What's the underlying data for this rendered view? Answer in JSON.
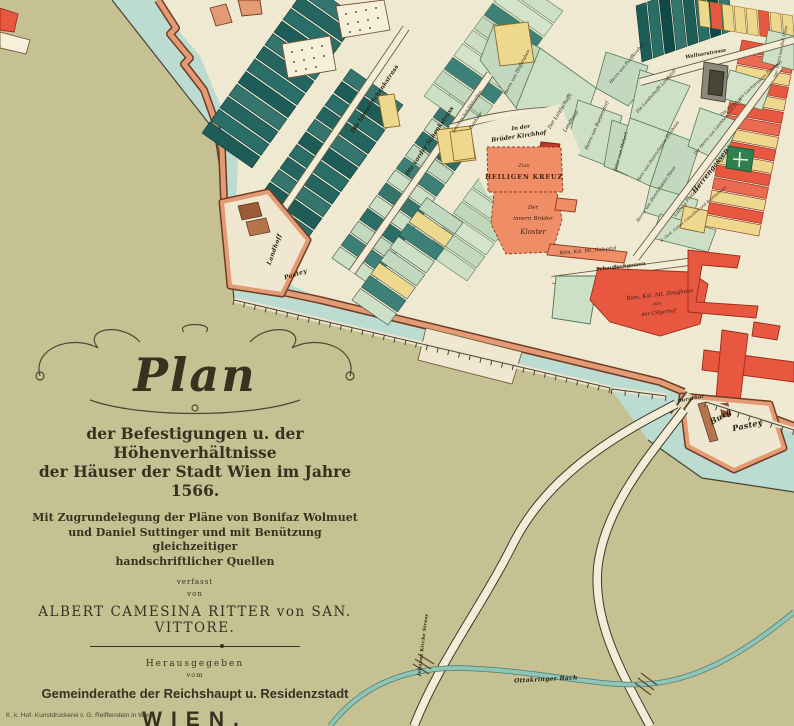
{
  "cartouche": {
    "title": "Plan",
    "line1": "der Befestigungen u. der Höhenverhältnisse",
    "line2": "der Häuser der Stadt Wien im Jahre 1566.",
    "line3": "Mit Zugrundelegung der Pläne von Bonifaz Wolmuet",
    "line4": "und Daniel Suttinger und mit Benützung gleichzeitiger",
    "line5": "handschriftlicher Quellen",
    "verfasst": "verfasst",
    "von": "von",
    "author": "ALBERT CAMESINA RITTER von SAN. VITTORE.",
    "herausgegeben": "Herausgegeben",
    "vom": "vom",
    "publisher": "Gemeinderathe der Reichshaupt u. Residenzstadt",
    "city": "WIEN.",
    "date": "Wien 1880.",
    "imprint": "K. k. Hof- Kunstdruckerei v. G. Reiffenstein in Wien."
  },
  "map": {
    "colors": {
      "glacis_olive": "#c6c193",
      "moat_teal": "#bddcd1",
      "city_cream": "#f0e9d2",
      "wall_salmon": "#e29b74",
      "wall_brown": "#6f3b24",
      "parcel_dark_teal": "#1d5c57",
      "parcel_celadon": "#cde0c6",
      "parcel_yellow": "#eed88d",
      "building_salmon": "#ee8d66",
      "building_red": "#e8573f",
      "stream_teal": "#8fc4b6",
      "ink": "#2e2517"
    },
    "city_poly": "158,0 178,30 200,56 214,90 228,122 238,162 236,206 246,264 320,298 662,382 688,394 706,400 762,414 794,428 794,0",
    "olive_poly": "0,0 112,0 214,130 226,208 234,300 610,388 648,440 702,478 794,492 794,726 0,726",
    "boundary_line": "M112,0 L214,130 L226,208 L234,300 L610,388 M648,440 L702,478 L794,492",
    "wall_paths": [
      "M158,0 L176,28 L170,34 L190,58 L184,64 L204,90 L214,118 L222,150 L224,200",
      "M282,292 L320,300 L660,382 L684,392",
      "M706,400 L762,414 L794,426"
    ],
    "strip_blocks": [
      {
        "name": "block-nw-dark",
        "x": 252,
        "y": 168,
        "sx": 9,
        "sy": -12.6,
        "lx": -50,
        "ly": -35,
        "n": 12,
        "colors": [
          "#1d5c57",
          "#2a6e68",
          "#24655f",
          "#35756d"
        ],
        "stroke": "#0c3c38"
      },
      {
        "name": "block-nw-dark2",
        "x": 305,
        "y": 242,
        "sx": 9,
        "sy": -12.6,
        "lx": -52,
        "ly": -36,
        "n": 11,
        "colors": [
          "#2a6e68",
          "#1d5c57",
          "#35756d",
          "#24655f"
        ],
        "stroke": "#0c3c38"
      },
      {
        "name": "block-schenk-mixed",
        "x": 332,
        "y": 258,
        "sx": 9.2,
        "sy": -12.8,
        "lx": 40,
        "ly": 28,
        "n": 13,
        "colors": [
          "#cde0c6",
          "#3c8077",
          "#c3d9bf",
          "#2a6e68",
          "#cde0c6",
          "#35756d"
        ],
        "stroke": "#2f4f42"
      },
      {
        "name": "block-vorder-celadon",
        "x": 425,
        "y": 252,
        "sx": 9.5,
        "sy": -13,
        "lx": 42,
        "ly": 29,
        "n": 13,
        "colors": [
          "#cde0c6",
          "#c3d9bf",
          "#d4e4cb",
          "#bfd8ba"
        ],
        "stroke": "#567a56"
      },
      {
        "name": "block-top-celadon",
        "x": 424,
        "y": 96,
        "sx": 10,
        "sy": -13.5,
        "lx": 50,
        "ly": 35,
        "n": 9,
        "colors": [
          "#cde0c6",
          "#c3d9bf",
          "#3c8077",
          "#d4e4cb"
        ],
        "stroke": "#567a56"
      },
      {
        "name": "block-right-strip",
        "x": 742,
        "y": 40,
        "sx": -2.5,
        "sy": 12.5,
        "lx": 54,
        "ly": 10,
        "n": 15,
        "colors": [
          "#e8573f",
          "#ea6a52",
          "#eed88d",
          "#e8573f",
          "#eed88d"
        ],
        "stroke": "#8c2418"
      },
      {
        "name": "block-ne-dark",
        "x": 642,
        "y": 62,
        "sx": 11.5,
        "sy": -4,
        "lx": -6,
        "ly": -56,
        "n": 8,
        "colors": [
          "#1d5c57",
          "#2a6e68",
          "#0f4a46",
          "#35756d"
        ],
        "stroke": "#0c3c38"
      },
      {
        "name": "block-ne-yellow",
        "x": 700,
        "y": 26,
        "sx": 12,
        "sy": 2,
        "lx": -2,
        "ly": -26,
        "n": 8,
        "colors": [
          "#eed88d",
          "#e8573f",
          "#eed88d",
          "#eed88d"
        ],
        "stroke": "#8c6b2a"
      },
      {
        "name": "block-mid-south",
        "x": 352,
        "y": 300,
        "sx": 9.5,
        "sy": -13,
        "lx": 36,
        "ly": 25,
        "n": 8,
        "colors": [
          "#cde0c6",
          "#3c8077",
          "#eed88d",
          "#c3d9bf"
        ],
        "stroke": "#2f4f42"
      }
    ],
    "parcels": [
      {
        "name": "parcel-pfaffstuben",
        "pts": "494,24 540,48 516,108 480,60",
        "fill": "#c3d9bf"
      },
      {
        "name": "parcel-landhaus",
        "pts": "540,48 596,88 566,176 516,108",
        "fill": "#cde0c6"
      },
      {
        "name": "parcel-pauffkirchen",
        "pts": "606,52 648,66 640,92 628,106 596,88",
        "fill": "#c3d9bf"
      },
      {
        "name": "parcel-landstall",
        "pts": "640,70 690,86 668,132 630,118",
        "fill": "#cde0c6"
      },
      {
        "name": "parcel-ruependorf",
        "pts": "578,100 622,116 608,166 566,150",
        "fill": "#cde0c6"
      },
      {
        "name": "parcel-mohart",
        "pts": "612,120 640,130 628,176 604,166",
        "fill": "#c3d9bf"
      },
      {
        "name": "parcel-dietrichstein-a",
        "pts": "630,118 668,132 650,186 616,170",
        "fill": "#cde0c6"
      },
      {
        "name": "parcel-dietrichstein-b",
        "pts": "668,132 700,144 682,200 650,186",
        "fill": "#c3d9bf"
      },
      {
        "name": "parcel-praelzner",
        "pts": "650,186 698,200 690,226 644,212",
        "fill": "#cde0c6"
      },
      {
        "name": "parcel-camer",
        "pts": "660,214 716,230 708,252 652,238",
        "fill": "#cde0c6"
      },
      {
        "name": "parcel-liechtenstein",
        "pts": "700,108 740,122 722,162 688,146",
        "fill": "#cde0c6"
      },
      {
        "name": "parcel-liecht-zins",
        "pts": "730,70 772,82 762,110 722,98",
        "fill": "#d4e4cb"
      },
      {
        "name": "parcel-roll",
        "pts": "768,30 794,36 794,70 762,62",
        "fill": "#cde0c6"
      }
    ],
    "streets": [
      {
        "name": "street-hinter-schenkstrass",
        "d": "M268,232 L406,28"
      },
      {
        "name": "street-vorder-schenkstrass",
        "d": "M352,272 L490,74"
      },
      {
        "name": "street-herrengasse",
        "d": "M636,258 L780,66"
      },
      {
        "name": "street-wallnerstrasse",
        "d": "M640,82 L794,40"
      },
      {
        "name": "street-schauflergasse",
        "d": "M552,280 L688,262"
      },
      {
        "name": "street-kirchhof-lane",
        "d": "M450,128 C490,116 520,112 560,110"
      }
    ],
    "shapes": [
      {
        "name": "kirchhof-court",
        "pts": "448,132 560,104 580,150 565,190 488,196 470,160",
        "fill": "#f0e9d2"
      },
      {
        "name": "garden-plot-1",
        "pts": "282,44 330,36 336,70 288,78",
        "fill": "#f6f0da",
        "stroke": "#7a5a3a"
      },
      {
        "name": "garden-plot-2",
        "pts": "336,6 384,0 390,30 342,38",
        "fill": "#f6f0da",
        "stroke": "#7a5a3a"
      },
      {
        "name": "yellow-parcel-1",
        "pts": "378,96 394,94 400,126 384,128",
        "fill": "#eed88d",
        "stroke": "#8c6b2a"
      },
      {
        "name": "yellow-parcel-2",
        "pts": "436,130 470,126 476,160 442,164",
        "fill": "#eed88d",
        "stroke": "#8c6b2a"
      },
      {
        "name": "yellow-parcel-3",
        "pts": "494,26 528,22 534,62 500,66",
        "fill": "#eed88d",
        "stroke": "#8c6b2a"
      },
      {
        "name": "yellow-parcel-4",
        "pts": "450,132 471,129 475,158 454,161",
        "fill": "#eed88d",
        "stroke": "#8c6b2a"
      },
      {
        "name": "yellow-parcel-5",
        "pts": "684,206 708,211 704,233 680,228",
        "fill": "#eed88d",
        "stroke": "#8c6b2a"
      },
      {
        "name": "gray-parcel",
        "pts": "704,62 728,66 725,102 701,98",
        "fill": "#8d8878",
        "stroke": "#4a4438"
      },
      {
        "name": "dark-parcel",
        "pts": "710,70 724,72 722,96 708,94",
        "fill": "#474538",
        "stroke": "#2a2820"
      },
      {
        "name": "green-cross-parcel",
        "pts": "728,146 754,150 751,172 726,168",
        "fill": "#2f7f4f",
        "stroke": "#1c5a34"
      },
      {
        "name": "church-cross-mark",
        "type": "path",
        "d": "M740,152 L739,167 M733,159 L748,160",
        "stroke": "#f6f0da",
        "sw": 1.6
      },
      {
        "name": "red-small-kirchhof",
        "pts": "541,142 560,144 558,153 539,151",
        "fill": "#c23b28",
        "stroke": "#7a1f12"
      },
      {
        "name": "kreuz-church",
        "pts": "487,147 561,147 563,192 488,192",
        "fill": "#ee8d66",
        "stroke": "#8d3a22",
        "dash": "3,2"
      },
      {
        "name": "kloster",
        "pts": "494,192 557,192 562,220 552,252 506,254 491,224",
        "fill": "#ee8d66",
        "stroke": "#8d3a22",
        "dash": "3,2"
      },
      {
        "name": "kloster-annex",
        "pts": "557,198 577,200 575,212 555,210",
        "fill": "#ee8d66",
        "stroke": "#8d3a22"
      },
      {
        "name": "hofspital",
        "pts": "550,244 627,252 624,263 547,255",
        "fill": "#ee8d66",
        "stroke": "#8d3a22"
      },
      {
        "name": "celadon-wedge",
        "pts": "556,276 598,276 590,324 552,318",
        "fill": "#cde0c6",
        "stroke": "#4d7356"
      },
      {
        "name": "zeughaus",
        "pts": "598,268 690,272 708,284 700,324 660,336 610,322 590,300",
        "fill": "#e8573f",
        "stroke": "#9c2c1c"
      },
      {
        "name": "zeughaus-wing",
        "pts": "688,250 740,256 737,268 702,265 696,302 758,306 756,318 688,312",
        "fill": "#e8573f",
        "stroke": "#9c2c1c"
      },
      {
        "name": "rampart-wedge",
        "pts": "426,328 522,352 512,384 418,360",
        "fill": "#efe7cf",
        "stroke": "#7a5a3a"
      },
      {
        "name": "hofburg-wing",
        "pts": "704,350 794,362 794,382 702,370",
        "fill": "#e8573f",
        "stroke": "#9c2c1c"
      },
      {
        "name": "hofburg-stem",
        "pts": "722,330 748,334 740,402 716,398",
        "fill": "#e8573f",
        "stroke": "#9c2c1c"
      },
      {
        "name": "hofburg-small",
        "pts": "754,322 780,326 777,340 752,336",
        "fill": "#e8573f",
        "stroke": "#9c2c1c"
      },
      {
        "name": "wall-bit-1",
        "pts": "210,8 226,4 232,22 216,26",
        "fill": "#e29b74",
        "stroke": "#6f3b24"
      },
      {
        "name": "wall-bit-2",
        "pts": "238,0 260,0 262,14 242,16",
        "fill": "#e29b74",
        "stroke": "#6f3b24"
      },
      {
        "name": "corner-red",
        "pts": "0,8 18,14 14,32 0,30",
        "fill": "#e8573f",
        "stroke": "#9c2c1c"
      },
      {
        "name": "corner-outwork",
        "pts": "0,32 30,40 26,54 0,48",
        "fill": "#f6f0da",
        "stroke": "#7a5a3a"
      }
    ],
    "garden_dots": [
      [
        292,
        52
      ],
      [
        302,
        50
      ],
      [
        312,
        48
      ],
      [
        322,
        46
      ],
      [
        294,
        62
      ],
      [
        304,
        60
      ],
      [
        314,
        58
      ],
      [
        324,
        56
      ],
      [
        296,
        71
      ],
      [
        306,
        69
      ],
      [
        316,
        67
      ],
      [
        346,
        14
      ],
      [
        356,
        12
      ],
      [
        366,
        10
      ],
      [
        376,
        8
      ],
      [
        348,
        24
      ],
      [
        358,
        22
      ],
      [
        368,
        20
      ],
      [
        378,
        18
      ],
      [
        350,
        32
      ],
      [
        360,
        30
      ],
      [
        370,
        28
      ]
    ],
    "bastions": [
      {
        "name": "bastion-landhoff",
        "pts": "222,202 268,192 308,240 282,294 230,286"
      },
      {
        "name": "bastion-burg",
        "pts": "682,396 770,404 784,448 734,470 688,446"
      }
    ],
    "bastion_details": [
      {
        "name": "bastion-detail",
        "pts": "238,206 258,202 262,216 242,220",
        "fill": "#9c5a36"
      },
      {
        "name": "bastion-detail",
        "pts": "246,222 266,218 270,232 250,236",
        "fill": "#b5754c"
      },
      {
        "name": "bastion-detail",
        "pts": "698,404 706,402 718,440 710,442",
        "fill": "#b5754c"
      },
      {
        "name": "bastion-detail",
        "pts": "720,404 728,403 730,416 722,417",
        "fill": "#9c5a36"
      }
    ],
    "bridge": {
      "name": "burgthor-bridge",
      "d": "M690,394 L674,416"
    },
    "roads": [
      {
        "name": "road-southwest",
        "d": "M676,404 C630,428 552,468 514,542 C480,610 440,660 414,726"
      },
      {
        "name": "road-southeast",
        "d": "M684,410 C650,455 606,505 598,565 C592,620 620,670 650,726"
      }
    ],
    "stream_path": "M330,726 C356,692 396,668 458,668 C540,670 600,688 648,684 C700,680 748,650 794,612",
    "stream_bridges": [
      "M415,659 L431,669 M418,654 L434,664 M413,664 L429,674",
      "M638,678 L654,690 M641,673 L657,685 M635,683 L651,695"
    ],
    "palisade_segments": [
      [
        234,
        300,
        610,
        388
      ],
      [
        612,
        389,
        666,
        396
      ],
      [
        706,
        402,
        794,
        430
      ]
    ],
    "labels": [
      {
        "t": "Die hinter Schenkstrass",
        "x": 376,
        "y": 100,
        "r": -56,
        "s": 6,
        "cls": "street"
      },
      {
        "t": "Die vorder Schenkstrass",
        "x": 431,
        "y": 142,
        "r": -56,
        "s": 6,
        "cls": "street"
      },
      {
        "t": "Herrengassen",
        "x": 712,
        "y": 172,
        "r": -52,
        "s": 7,
        "cls": "street"
      },
      {
        "t": "Wallnerstrasse",
        "x": 706,
        "y": 55,
        "r": -10,
        "s": 5,
        "cls": "street"
      },
      {
        "t": "Schauflechgassen",
        "x": 621,
        "y": 268,
        "r": -7,
        "s": 5,
        "cls": "street"
      },
      {
        "t": "In der",
        "x": 521,
        "y": 129,
        "r": -8,
        "s": 5.5,
        "cls": "street"
      },
      {
        "t": "Brüder Kirchhof",
        "x": 519,
        "y": 138,
        "r": -8,
        "s": 6,
        "cls": "street"
      },
      {
        "t": "Zum",
        "x": 524,
        "y": 167,
        "r": 0,
        "s": 5,
        "cls": "kreuz"
      },
      {
        "t": "HEILIGEN KREUZ",
        "x": 524,
        "y": 179,
        "r": 0,
        "s": 6.5,
        "cls": "kreuzcaps"
      },
      {
        "t": "Der",
        "x": 533,
        "y": 209,
        "r": 0,
        "s": 5.5,
        "cls": "kreuz"
      },
      {
        "t": "innern Brüder",
        "x": 533,
        "y": 220,
        "r": 0,
        "s": 5.5,
        "cls": "kreuz"
      },
      {
        "t": "Kloster",
        "x": 533,
        "y": 234,
        "r": 0,
        "s": 7,
        "cls": "kreuz"
      },
      {
        "t": "Röm. Kai. Mt. Hofspital",
        "x": 588,
        "y": 252,
        "r": -5,
        "s": 4.8,
        "cls": "small"
      },
      {
        "t": "Röm. Kai. Mt. Zeughaus",
        "x": 660,
        "y": 296,
        "r": -7,
        "s": 5.5,
        "cls": "small"
      },
      {
        "t": "olim",
        "x": 657,
        "y": 305,
        "r": -7,
        "s": 4,
        "cls": "small"
      },
      {
        "t": "der Cillyerhof",
        "x": 659,
        "y": 314,
        "r": -7,
        "s": 5,
        "cls": "small"
      },
      {
        "t": "Burgthor",
        "x": 691,
        "y": 400,
        "r": -10,
        "s": 4.8,
        "cls": "frak"
      },
      {
        "t": "Burg",
        "x": 722,
        "y": 419,
        "r": -30,
        "s": 8,
        "cls": "frak"
      },
      {
        "t": "Pastey",
        "x": 748,
        "y": 428,
        "r": -12,
        "s": 8,
        "cls": "frak"
      },
      {
        "t": "Landhoff",
        "x": 276,
        "y": 250,
        "r": -70,
        "s": 6,
        "cls": "frak"
      },
      {
        "t": "Pastey",
        "x": 296,
        "y": 276,
        "r": -18,
        "s": 6,
        "cls": "frak"
      },
      {
        "t": "Herrn von Pfaffstuben",
        "x": 518,
        "y": 73,
        "r": -62,
        "s": 4.5,
        "cls": "small"
      },
      {
        "t": "Der Landschafft",
        "x": 561,
        "y": 112,
        "r": -58,
        "s": 5,
        "cls": "small"
      },
      {
        "t": "Landhaus",
        "x": 572,
        "y": 122,
        "r": -58,
        "s": 5,
        "cls": "small"
      },
      {
        "t": "Herrn von Pauffkirchen",
        "x": 628,
        "y": 64,
        "r": -50,
        "s": 4.4,
        "cls": "small"
      },
      {
        "t": "Die Landschafft Landstall",
        "x": 657,
        "y": 92,
        "r": -48,
        "s": 4.4,
        "cls": "small"
      },
      {
        "t": "Herrn von Ruependorf",
        "x": 598,
        "y": 126,
        "r": -66,
        "s": 4.6,
        "cls": "small"
      },
      {
        "t": "Peter von Mohart",
        "x": 622,
        "y": 152,
        "r": -74,
        "s": 4.6,
        "cls": "small"
      },
      {
        "t": "Herr von Dietrichstein Zinshaus",
        "x": 659,
        "y": 152,
        "r": -56,
        "s": 4.4,
        "cls": "small"
      },
      {
        "t": "Herrn von Dietrichstein Haus",
        "x": 657,
        "y": 195,
        "r": -56,
        "s": 4.4,
        "cls": "small"
      },
      {
        "t": "Ludwig Prätzner",
        "x": 688,
        "y": 202,
        "r": -50,
        "s": 4.6,
        "cls": "small"
      },
      {
        "t": "N. Oest. Camer. Cancellist und Buchhalterei",
        "x": 694,
        "y": 215,
        "r": -40,
        "s": 3.8,
        "cls": "small"
      },
      {
        "t": "Die Herrn von Liechtenstain Haus",
        "x": 719,
        "y": 127,
        "r": -50,
        "s": 4.2,
        "cls": "small"
      },
      {
        "t": "Die Herrn von Liechtenstain Zinshaus",
        "x": 752,
        "y": 89,
        "r": -42,
        "s": 4.2,
        "cls": "small"
      },
      {
        "t": "Der Herrn von Roll Haus",
        "x": 782,
        "y": 52,
        "r": -78,
        "s": 4.2,
        "cls": "small"
      },
      {
        "t": "Joachim Schöllkhreben",
        "x": 468,
        "y": 112,
        "r": -56,
        "s": 4.2,
        "cls": "small"
      },
      {
        "t": "Batthaler",
        "x": 477,
        "y": 121,
        "r": -56,
        "s": 4.2,
        "cls": "small"
      },
      {
        "t": "Ottakringer Bach",
        "x": 546,
        "y": 681,
        "r": -3,
        "s": 6,
        "cls": "frak"
      },
      {
        "t": "Johanns Kirche Strass",
        "x": 424,
        "y": 645,
        "r": -83,
        "s": 4.5,
        "cls": "frak"
      }
    ]
  }
}
